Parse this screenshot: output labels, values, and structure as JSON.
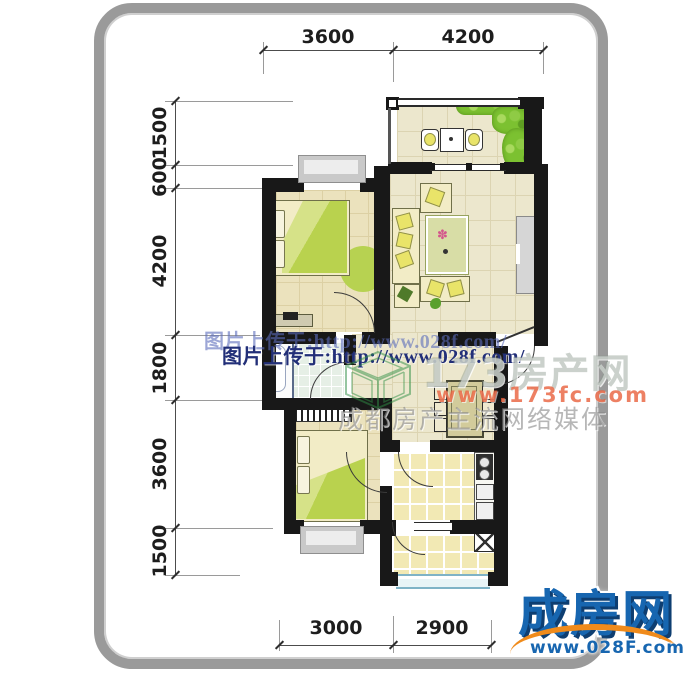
{
  "dimensions": {
    "top": [
      "3600",
      "4200"
    ],
    "left": [
      "1500",
      "600",
      "4200",
      "1800",
      "3600",
      "1500"
    ],
    "bottom": [
      "3000",
      "2900"
    ]
  },
  "watermarks": {
    "upload_line_ghost": "图片上传于:http://www.028f.com/",
    "upload_line": "图片上传于:http://www.028f.com/",
    "portal_name": "173房产网",
    "portal_url": "www.173fc.com",
    "portal_slogan": "成都房产主流网络媒体"
  },
  "logo": {
    "brand": "成房网",
    "url": "www.028F.com"
  },
  "colors": {
    "panel_border": "#9a9a9a",
    "wall": "#181818",
    "floor_beige": "#ece7cd",
    "floor_bedroom": "#ebe2bd",
    "tile_kitchen": "#f2e9b4",
    "tile_bath": "#e6efe6",
    "blanket_green": "#b9d24e",
    "plant_green": "#7cc131",
    "watermark_navy": "#222f78",
    "brand_blue": "#1766b0",
    "brand_orange": "#f08b1b"
  }
}
